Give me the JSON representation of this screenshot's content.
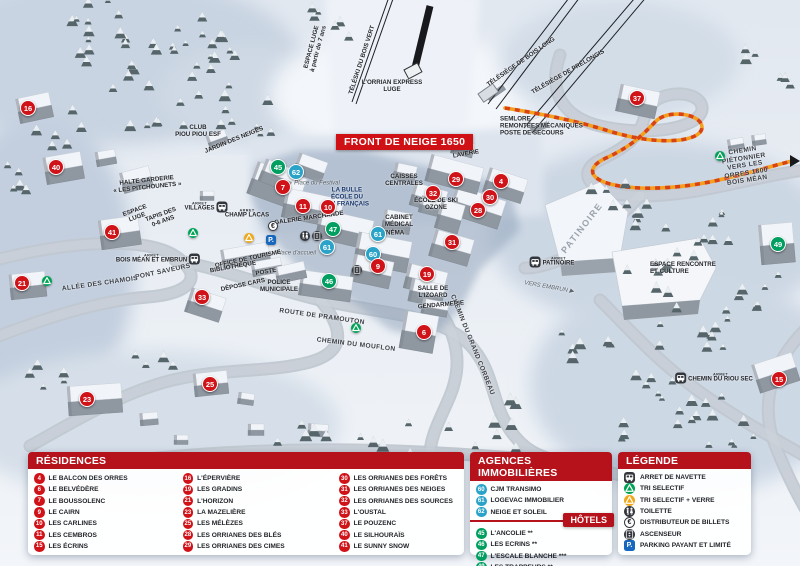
{
  "banner": {
    "text": "FRONT DE NEIGE 1650"
  },
  "colors": {
    "r": "#cf1318",
    "h": "#009e60",
    "a": "#2ba3c9",
    "header": "#b5121b"
  },
  "map": {
    "markers": [
      {
        "n": "16",
        "t": "r",
        "x": 28,
        "y": 108
      },
      {
        "n": "40",
        "t": "r",
        "x": 56,
        "y": 167
      },
      {
        "n": "41",
        "t": "r",
        "x": 112,
        "y": 232
      },
      {
        "n": "21",
        "t": "r",
        "x": 22,
        "y": 283
      },
      {
        "n": "33",
        "t": "r",
        "x": 202,
        "y": 297
      },
      {
        "n": "23",
        "t": "r",
        "x": 87,
        "y": 399
      },
      {
        "n": "25",
        "t": "r",
        "x": 210,
        "y": 384
      },
      {
        "n": "45",
        "t": "h",
        "x": 278,
        "y": 167
      },
      {
        "n": "62",
        "t": "a",
        "x": 296,
        "y": 172
      },
      {
        "n": "7",
        "t": "r",
        "x": 283,
        "y": 187
      },
      {
        "n": "11",
        "t": "r",
        "x": 303,
        "y": 206
      },
      {
        "n": "10",
        "t": "r",
        "x": 328,
        "y": 207
      },
      {
        "n": "47",
        "t": "h",
        "x": 333,
        "y": 229
      },
      {
        "n": "61",
        "t": "a",
        "x": 327,
        "y": 247
      },
      {
        "n": "61",
        "t": "a",
        "x": 378,
        "y": 234
      },
      {
        "n": "60",
        "t": "a",
        "x": 373,
        "y": 254
      },
      {
        "n": "9",
        "t": "r",
        "x": 378,
        "y": 266
      },
      {
        "n": "46",
        "t": "h",
        "x": 329,
        "y": 281
      },
      {
        "n": "19",
        "t": "r",
        "x": 427,
        "y": 274
      },
      {
        "n": "6",
        "t": "r",
        "x": 424,
        "y": 332
      },
      {
        "n": "31",
        "t": "r",
        "x": 452,
        "y": 242
      },
      {
        "n": "28",
        "t": "r",
        "x": 478,
        "y": 210
      },
      {
        "n": "30",
        "t": "r",
        "x": 490,
        "y": 197
      },
      {
        "n": "32",
        "t": "r",
        "x": 433,
        "y": 193
      },
      {
        "n": "29",
        "t": "r",
        "x": 456,
        "y": 179
      },
      {
        "n": "4",
        "t": "r",
        "x": 501,
        "y": 181
      },
      {
        "n": "37",
        "t": "r",
        "x": 637,
        "y": 98
      },
      {
        "n": "49",
        "t": "h",
        "x": 778,
        "y": 244
      },
      {
        "n": "15",
        "t": "r",
        "x": 779,
        "y": 379
      }
    ],
    "labels": [
      {
        "tx": "ESPACE LUGE\nà partir de 7 ans",
        "x": 315,
        "y": 48,
        "r": -75,
        "s": "dark"
      },
      {
        "tx": "TÉLÉSKI DU BOIS VERT",
        "x": 362,
        "y": 60,
        "r": -72,
        "s": "dark"
      },
      {
        "tx": "L'ORRIAN EXPRESS\nLUGE",
        "x": 392,
        "y": 86,
        "r": 0,
        "s": "dark"
      },
      {
        "tx": "TÉLÉSIÈGE DE BOIS LONG",
        "x": 521,
        "y": 62,
        "r": -35,
        "s": "dark"
      },
      {
        "tx": "TÉLÉSIÈGE DE PRÉLONGIS",
        "x": 568,
        "y": 72,
        "r": -30,
        "s": "dark"
      },
      {
        "tx": "SEMLORE\nREMONTÉES MÉCANIQUES\nPOSTE DE SECOURS",
        "x": 500,
        "y": 126,
        "r": 0,
        "s": "dark",
        "a": "left"
      },
      {
        "tx": "CLUB\nPIOU PIOU ESF",
        "x": 198,
        "y": 131,
        "r": 0,
        "s": "dark"
      },
      {
        "tx": "JARDIN DES NEIGES",
        "x": 234,
        "y": 140,
        "r": -22,
        "s": "dark"
      },
      {
        "tx": "HALTE GARDERIE\n« LES PITCHOUNETS »",
        "x": 147,
        "y": 184,
        "r": -6,
        "s": "dark"
      },
      {
        "tx": "ESPACE\nLUGE",
        "x": 136,
        "y": 214,
        "r": -20,
        "s": "dark"
      },
      {
        "tx": "TAPIS DES\n0-6 ANS",
        "x": 162,
        "y": 218,
        "r": -20,
        "s": "dark"
      },
      {
        "tx": "LA BULLE\nÉCOLE DU\nSKI FRANÇAIS",
        "x": 347,
        "y": 197,
        "r": 0,
        "s": "navy"
      },
      {
        "tx": "Place du Festival",
        "x": 317,
        "y": 184,
        "r": 0,
        "s": "it"
      },
      {
        "tx": "GALERIE MARCHANDE",
        "x": 309,
        "y": 218,
        "r": -8,
        "s": "dark"
      },
      {
        "tx": "CAISSES\nCENTRALES",
        "x": 404,
        "y": 180,
        "r": 0,
        "s": "dark"
      },
      {
        "tx": "LAVERIE",
        "x": 466,
        "y": 154,
        "r": -10,
        "s": "dark"
      },
      {
        "tx": "ÉCOLE DE SKI\nOZONE",
        "x": 436,
        "y": 204,
        "r": 0,
        "s": "dark"
      },
      {
        "tx": "CABINET\nMÉDICAL",
        "x": 399,
        "y": 221,
        "r": 0,
        "s": "dark"
      },
      {
        "tx": "CINÉMA",
        "x": 392,
        "y": 233,
        "r": 0,
        "s": "dark"
      },
      {
        "tx": "Place d'accueil",
        "x": 296,
        "y": 254,
        "r": 0,
        "s": "it"
      },
      {
        "tx": "OFFICE DE TOURISME",
        "x": 248,
        "y": 259,
        "r": -12,
        "s": "dark"
      },
      {
        "tx": "BIBLIOTHÈQUE",
        "x": 233,
        "y": 267,
        "r": -10,
        "s": "dark"
      },
      {
        "tx": "POSTE",
        "x": 266,
        "y": 272,
        "r": -10,
        "s": "dark"
      },
      {
        "tx": "DÉPOSE CARS",
        "x": 243,
        "y": 285,
        "r": -12,
        "s": "dark"
      },
      {
        "tx": "POLICE\nMUNICIPALE",
        "x": 279,
        "y": 286,
        "r": 0,
        "s": "dark"
      },
      {
        "tx": "PONT SAVEURS",
        "x": 163,
        "y": 272,
        "r": -12,
        "s": "road"
      },
      {
        "tx": "ALLÉE DES CHAMOIS",
        "x": 100,
        "y": 284,
        "r": -8,
        "s": "road"
      },
      {
        "tx": "ROUTE DE PRAMOUTON",
        "x": 322,
        "y": 317,
        "r": 8,
        "s": "road"
      },
      {
        "tx": "CHEMIN DU MOUFLON",
        "x": 356,
        "y": 345,
        "r": 7,
        "s": "road"
      },
      {
        "tx": "CHEMIN DU GRAND CORBEAU",
        "x": 472,
        "y": 345,
        "r": 68,
        "s": "road"
      },
      {
        "tx": "SALLE DE\nL'IZOARD",
        "x": 433,
        "y": 292,
        "r": 0,
        "s": "dark"
      },
      {
        "tx": "GENDARMERIE",
        "x": 441,
        "y": 305,
        "r": -5,
        "s": "dark"
      },
      {
        "tx": "VERS EMBRUN ▶",
        "x": 549,
        "y": 288,
        "r": 10,
        "s": "it"
      },
      {
        "tx": "PATINOIRE",
        "x": 582,
        "y": 228,
        "r": -52,
        "s": "big"
      },
      {
        "tx": "ESPACE RENCONTRE\nET CULTURE",
        "x": 650,
        "y": 268,
        "r": 0,
        "s": "dark",
        "a": "left"
      },
      {
        "tx": "CHEMIN PIÉTONNIER\nVERS LES ORRES 1800\nBOIS MÉAN",
        "x": 745,
        "y": 166,
        "r": -9,
        "s": "road"
      }
    ],
    "stops_prefix": "ARRET",
    "stops": [
      {
        "l": "VILLAGES",
        "x": 206,
        "y": 207,
        "side": "right"
      },
      {
        "l": "CHAMP LACAS",
        "x": 247,
        "y": 214,
        "side": "none"
      },
      {
        "l": "BOIS MÉAN ET EMBRUN",
        "x": 158,
        "y": 259,
        "side": "right"
      },
      {
        "l": "PATINOIRE",
        "x": 552,
        "y": 262,
        "side": "left"
      },
      {
        "l": "CHEMIN DU RIOU SEC",
        "x": 714,
        "y": 378,
        "side": "left"
      }
    ],
    "pois": [
      {
        "k": "euro",
        "x": 273,
        "y": 226
      },
      {
        "k": "recycle_yellow",
        "x": 249,
        "y": 238
      },
      {
        "k": "parking",
        "x": 271,
        "y": 240
      },
      {
        "k": "toilet",
        "x": 305,
        "y": 236
      },
      {
        "k": "elevator",
        "x": 317,
        "y": 236
      },
      {
        "k": "elevator",
        "x": 357,
        "y": 270
      },
      {
        "k": "recycle_green",
        "x": 47,
        "y": 281
      },
      {
        "k": "recycle_green",
        "x": 193,
        "y": 233
      },
      {
        "k": "recycle_green",
        "x": 356,
        "y": 328
      },
      {
        "k": "recycle_green",
        "x": 720,
        "y": 156
      }
    ]
  },
  "panels": {
    "residences": {
      "title": "RÉSIDENCES",
      "columns": [
        [
          {
            "n": "4",
            "l": "LE BALCON DES ORRES"
          },
          {
            "n": "6",
            "l": "LE BELVÉDÈRE"
          },
          {
            "n": "7",
            "l": "LE BOUSSOLENC"
          },
          {
            "n": "9",
            "l": "LE CAIRN"
          },
          {
            "n": "10",
            "l": "LES CARLINES"
          },
          {
            "n": "11",
            "l": "LES CEMBROS"
          },
          {
            "n": "15",
            "l": "LES ÉCRINS"
          }
        ],
        [
          {
            "n": "16",
            "l": "L'ÉPERVIÈRE"
          },
          {
            "n": "19",
            "l": "LES GRADINS"
          },
          {
            "n": "21",
            "l": "L'HORIZON"
          },
          {
            "n": "23",
            "l": "LA MAZELIÈRE"
          },
          {
            "n": "25",
            "l": "LES MÉLÈZES"
          },
          {
            "n": "28",
            "l": "LES ORRIANES DES BLÉS"
          },
          {
            "n": "29",
            "l": "LES ORRIANES DES CIMES"
          }
        ],
        [
          {
            "n": "30",
            "l": "LES ORRIANES DES FORÊTS"
          },
          {
            "n": "31",
            "l": "LES ORRIANES DES NEIGES"
          },
          {
            "n": "32",
            "l": "LES ORRIANES DES SOURCES"
          },
          {
            "n": "33",
            "l": "L'OUSTAL"
          },
          {
            "n": "37",
            "l": "LE POUZENC"
          },
          {
            "n": "40",
            "l": "LE SILHOURAÏS"
          },
          {
            "n": "41",
            "l": "LE SUNNY SNOW"
          }
        ]
      ]
    },
    "agences": {
      "title": "AGENCES IMMOBILIÈRES",
      "items": [
        {
          "n": "60",
          "l": "CJM TRANSIMO"
        },
        {
          "n": "61",
          "l": "LOGEVAC IMMOBILIER"
        },
        {
          "n": "62",
          "l": "NEIGE ET SOLEIL"
        }
      ]
    },
    "hotels": {
      "title": "HÔTELS",
      "items": [
        {
          "n": "45",
          "l": "L'ANCOLIE **"
        },
        {
          "n": "46",
          "l": "LES ECRINS **"
        },
        {
          "n": "47",
          "l": "L'ESCALE BLANCHE ***"
        },
        {
          "n": "49",
          "l": "LES TRAPPEURS **"
        }
      ]
    },
    "legende": {
      "title": "LÉGENDE",
      "items": [
        {
          "k": "bus",
          "l": "ARRET DE NAVETTE"
        },
        {
          "k": "recycle_green",
          "l": "TRI SELECTIF"
        },
        {
          "k": "recycle_yellow",
          "l": "TRI SELECTIF + VERRE"
        },
        {
          "k": "toilet",
          "l": "TOILETTE"
        },
        {
          "k": "euro",
          "l": "DISTRIBUTEUR DE BILLETS"
        },
        {
          "k": "elevator",
          "l": "ASCENSEUR"
        },
        {
          "k": "parking",
          "l": "PARKING PAYANT ET LIMITÉ"
        }
      ]
    }
  }
}
